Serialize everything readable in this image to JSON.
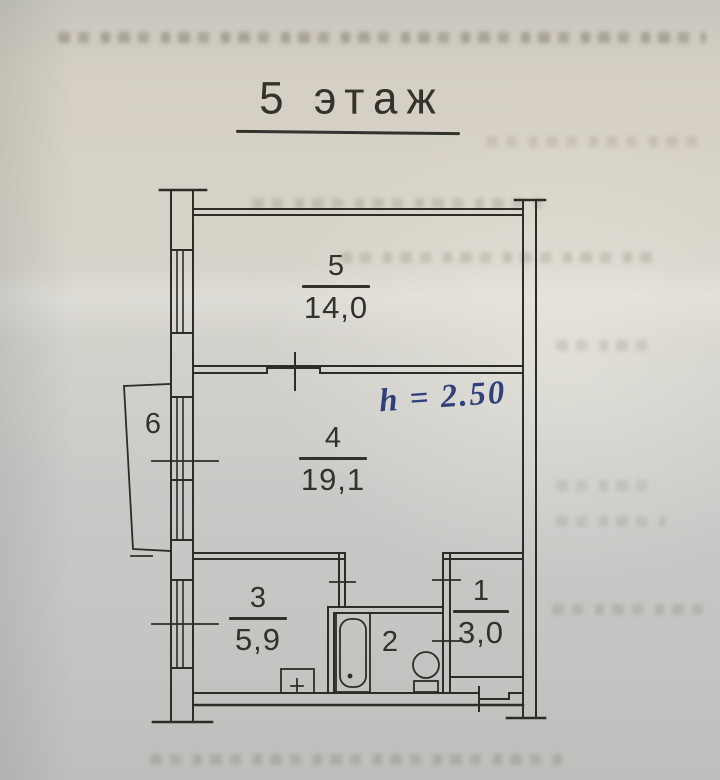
{
  "document": {
    "type": "scanned floor plan",
    "title": "5 этаж"
  },
  "handwritten_note": {
    "text": "h = 2.50",
    "ink_color": "#31407c"
  },
  "rooms": {
    "1": {
      "number": "1",
      "area": "3,0"
    },
    "2": {
      "number": "2",
      "area": ""
    },
    "3": {
      "number": "3",
      "area": "5,9"
    },
    "4": {
      "number": "4",
      "area": "19,1"
    },
    "5": {
      "number": "5",
      "area": "14,0"
    },
    "6": {
      "number": "6",
      "area": ""
    }
  },
  "colors": {
    "paper": "#d1cfc8",
    "line": "#2e2c27",
    "pen_ink": "#31407c"
  },
  "icons": {
    "bathtub": "bathtub-icon",
    "toilet": "toilet-icon",
    "stove": "stove-icon",
    "window": "window-glazing-lines",
    "balcony": "balcony-outline"
  }
}
